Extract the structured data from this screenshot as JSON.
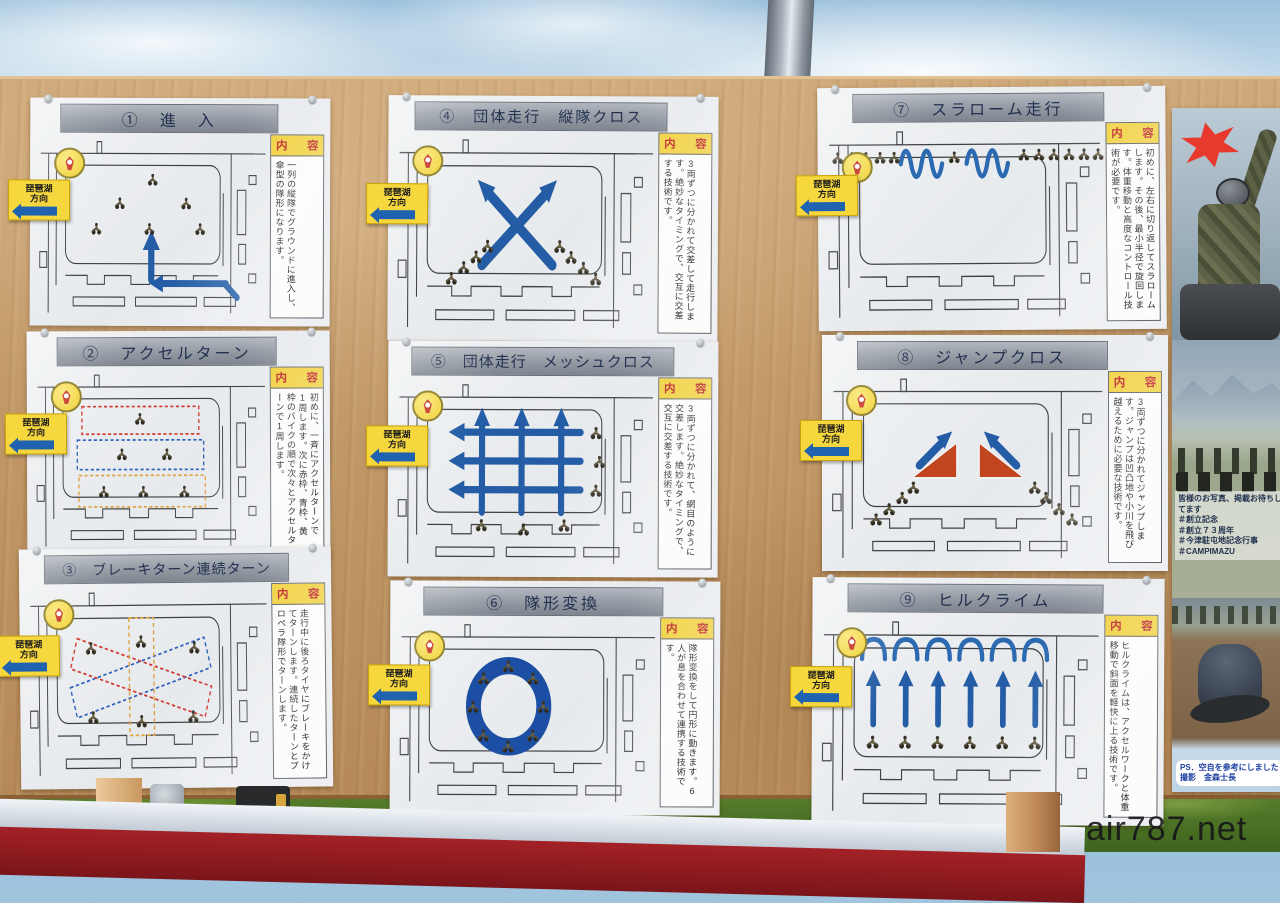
{
  "labels": {
    "naiyou": "内　容",
    "sign_line1": "琵琶湖",
    "sign_line2": "方向"
  },
  "panels": [
    {
      "title": "①　進　入",
      "content": "一列の縦隊でグラウンドに進入し、傘型の隊形になります。"
    },
    {
      "title": "②　アクセルターン",
      "content": "初めに、一斉にアクセルターンで1周します。次に赤枠、青枠、黄枠のバイクの順で次々とアクセルターンで1周します。"
    },
    {
      "title": "③　ブレーキターン連続ターン",
      "content": "走行中に後ろタイヤにブレーキをかけてターンします。連続したターンとプロペラ隊形でターンします。"
    },
    {
      "title": "④　団体走行　縦隊クロス",
      "content": "3両ずつに分かれて交差して走行します。絶妙なタイミングで、交互に交差する技術です。"
    },
    {
      "title": "⑤　団体走行　メッシュクロス",
      "content": "3両ずつに分かれて、網目のように交差します。絶妙なタイミングで、交互に交差する技術です。"
    },
    {
      "title": "⑥　隊形変換",
      "content": "隊形変換をして円形に動きます。6人が息を合わせて連携する技術です。"
    },
    {
      "title": "⑦　スラローム走行",
      "content": "初めに、左右に切り返してスラロームします。その後、最小半径で旋回します。体重移動と高度なコントロール技術が必要です。"
    },
    {
      "title": "⑧　ジャンプクロス",
      "content": "3両ずつに分かれてジャンプします。ジャンプは凹凸地や小川を飛び越えるために必要な技術です。"
    },
    {
      "title": "⑨　ヒルクライム",
      "content": "ヒルクライムは、アクセルワークと体重移動で斜面を軽快に上る技術です。"
    }
  ],
  "photo_column": {
    "caption": "皆様のお写真、掲載お待ちしてます",
    "hashtags": [
      "＃創立記念",
      "＃創立７３周年",
      "＃今津駐屯地記念行事",
      "＃CAMPIMAZU"
    ],
    "ps_line1": "PS．空自を参考にしました",
    "ps_line2": "撮影　金森士長"
  },
  "watermark": "air787.net",
  "colors": {
    "arrow_blue": "#245da6",
    "ring_blue": "#1c4fa3",
    "ramp_orange": "#c1451d",
    "dashed_red": "#cf3a30",
    "dashed_blue": "#2f62bd",
    "dashed_yellow": "#dfa23f",
    "sign_yellow": "#f6d73e",
    "naiyou_yellow": "#f0d03c",
    "naiyou_red": "#bb2025"
  }
}
